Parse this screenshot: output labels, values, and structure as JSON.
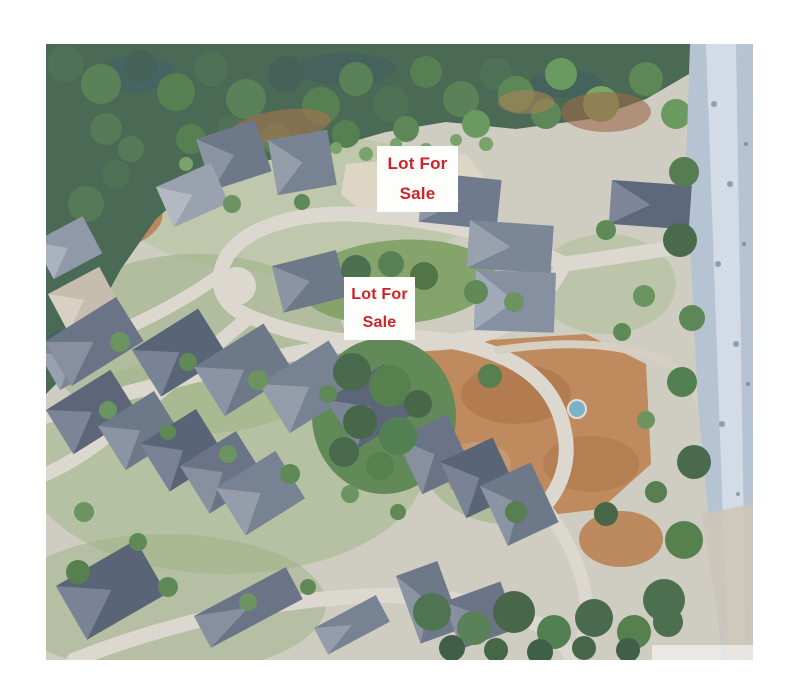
{
  "photo": {
    "alt": "Aerial photo of a forest-edged suburban neighborhood with a cul-de-sac of large homes, rows of gray-roofed houses, brown vacant lots and a tree-lined road on the right",
    "labels": [
      {
        "line1": "Lot For",
        "line2": "Sale",
        "text_color": "#cf2329",
        "background_color": "#fdfdfc"
      },
      {
        "line1": "Lot For",
        "line2": "Sale",
        "text_color": "#cf2329",
        "background_color": "#fdfdfc"
      }
    ],
    "palette": {
      "page_background": "#ffffff",
      "forest_green": "#4a6a55",
      "lawn_green": "#9fb584",
      "street_gray": "#dcd8cf",
      "dirt_brown": "#bf8b5e",
      "roof_slate": "#667083",
      "road_blue_gray": "#b5c3d3",
      "pool_blue": "#7ab3c9"
    }
  }
}
